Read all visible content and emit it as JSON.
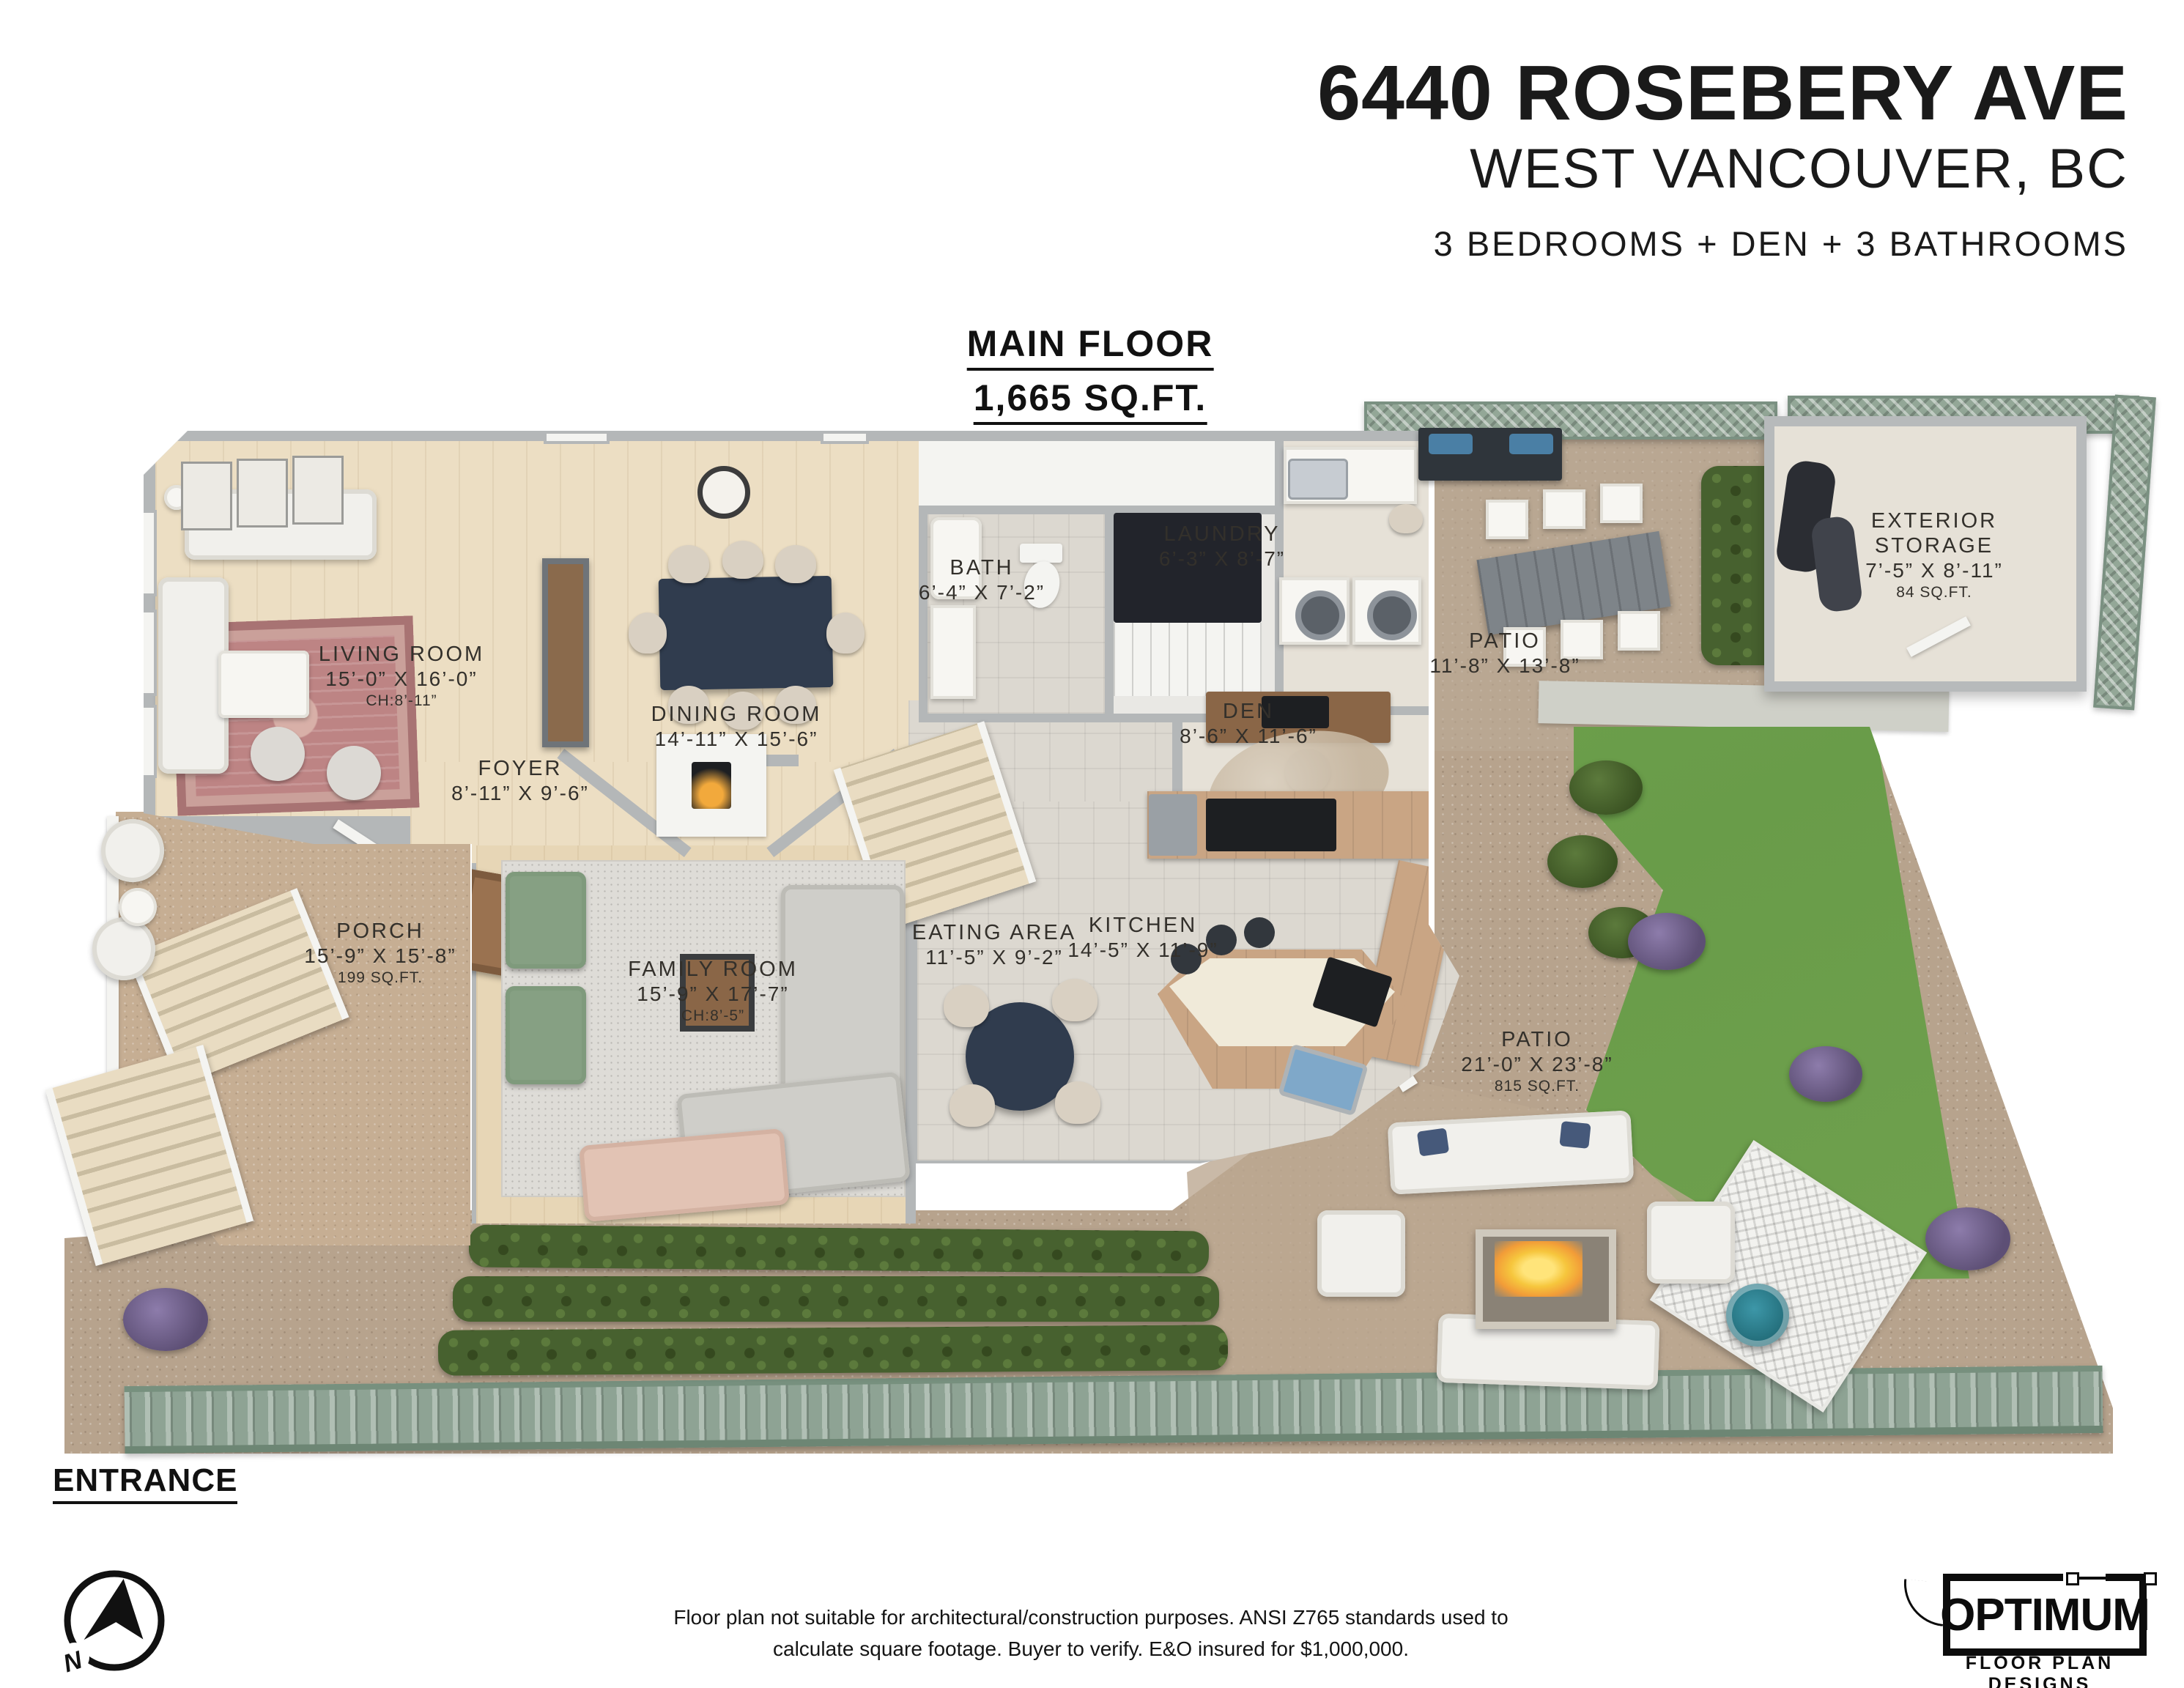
{
  "header": {
    "address": "6440 ROSEBERY AVE",
    "city": "WEST VANCOUVER, BC",
    "summary": "3 BEDROOMS + DEN + 3 BATHROOMS"
  },
  "floor_title": {
    "name": "MAIN FLOOR",
    "area": "1,665 SQ.FT."
  },
  "rooms": [
    {
      "id": "living-room",
      "name": "LIVING ROOM",
      "dims": "15’-0” X 16’-0”",
      "note": "CH:8’-11”"
    },
    {
      "id": "dining-room",
      "name": "DINING ROOM",
      "dims": "14’-11” X 15’-6”",
      "note": ""
    },
    {
      "id": "bath",
      "name": "BATH",
      "dims": "6’-4” X 7’-2”",
      "note": ""
    },
    {
      "id": "laundry",
      "name": "LAUNDRY",
      "dims": "6’-3” X 8’-7”",
      "note": ""
    },
    {
      "id": "patio-upper",
      "name": "PATIO",
      "dims": "11’-8” X 13’-8”",
      "note": ""
    },
    {
      "id": "exterior-storage",
      "name": "EXTERIOR STORAGE",
      "dims": "7’-5” X 8’-11”",
      "note": "84 SQ.FT."
    },
    {
      "id": "den",
      "name": "DEN",
      "dims": "8’-6” X 11’-6”",
      "note": ""
    },
    {
      "id": "foyer",
      "name": "FOYER",
      "dims": "8’-11” X 9’-6”",
      "note": ""
    },
    {
      "id": "porch",
      "name": "PORCH",
      "dims": "15’-9” X 15’-8”",
      "note": "199 SQ.FT."
    },
    {
      "id": "family-room",
      "name": "FAMILY ROOM",
      "dims": "15’-9” X 17’-7”",
      "note": "CH:8’-5”"
    },
    {
      "id": "eating-area",
      "name": "EATING AREA",
      "dims": "11’-5” X 9’-2”",
      "note": ""
    },
    {
      "id": "kitchen",
      "name": "KITCHEN",
      "dims": "14’-5” X 11’-9”",
      "note": ""
    },
    {
      "id": "patio-lower",
      "name": "PATIO",
      "dims": "21’-0” X 23’-8”",
      "note": "815 SQ.FT."
    }
  ],
  "entrance_label": "ENTRANCE",
  "compass": {
    "north": "N"
  },
  "footer": {
    "disclaimer_line1": "Floor plan not suitable for architectural/construction purposes. ANSI Z765 standards used to",
    "disclaimer_line2": "calculate square footage. Buyer to verify.  E&O insured for $1,000,000.",
    "logo_name": "OPTIMUM",
    "logo_tagline": "FLOOR PLAN DESIGNS"
  },
  "colors": {
    "dirt": "#b7a38d",
    "lawn": "#74a452",
    "hedge": "#47612f",
    "fence_sage": "#8ea394",
    "wood_floor": "#ecdec3",
    "tile_floor": "#dcd8d0",
    "wall": "#b4b7b8",
    "rug_rose": "#bd8484",
    "table_navy": "#303c4e",
    "fire_glow": "#f6c63d",
    "teal_stool": "#2e8495"
  }
}
